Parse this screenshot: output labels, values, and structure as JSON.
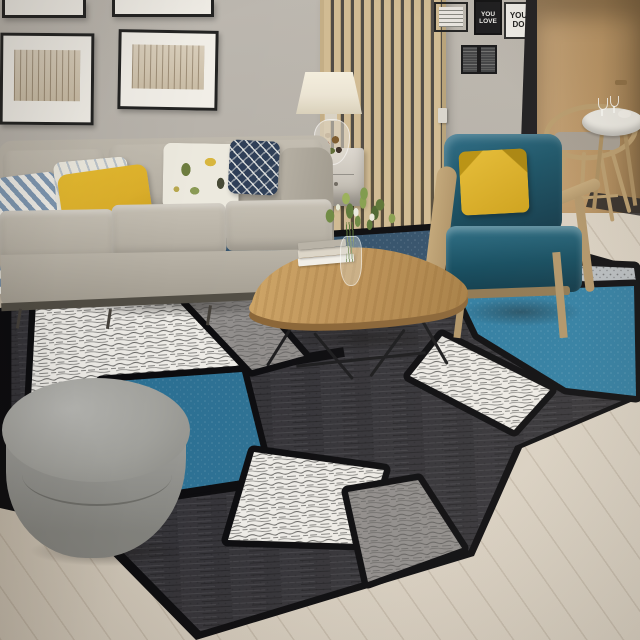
{
  "scene": {
    "type": "living-room-photograph",
    "posters": {
      "black_poster_text": "YOU LOVE",
      "white_poster_text": "YOU DO"
    }
  },
  "palette": {
    "wall": "#b6b1a9",
    "wall_dark": "#a39e96",
    "floor": "#cfc6b7",
    "floor_light": "#ddd5c7",
    "door": "#c2a075",
    "door_dark": "#8f6f45",
    "doorway_shadow": "#1b1a1d",
    "divider_wood": "#d0ba92",
    "sofa": "#b6b0a4",
    "sofa_light": "#c6c0b4",
    "sofa_rail": "#514d44",
    "pillow_yellow": "#ddb02b",
    "pillow_chevron": "#7f98b2",
    "pillow_navy": "#2e3e57",
    "pillow_cream": "#ece9de",
    "armchair_teal": "#175064",
    "armchair_teal_light": "#2b6d85",
    "armchair_wood": "#b09468",
    "rug_black": "#0b0b0e",
    "rug_charcoal": "#343338",
    "rug_white": "#edebe6",
    "rug_grey": "#908d8b",
    "rug_navy": "#33516b",
    "rug_teal": "#2f7da2",
    "rug_teal_deep": "#2c7093",
    "rug_lightband": "#b7bcc0",
    "ottoman": "#a0a09b",
    "ottoman_dark": "#82827d",
    "table_wood": "#bf9459",
    "table_wood_dark": "#8a6537",
    "lamp_shade": "#ebe4d3",
    "dining_wood": "#b89b6c",
    "dining_seat": "#a59d92",
    "table_top": "#eae8e2",
    "poster_black_bg": "#17171a",
    "poster_white_bg": "#f0eee9",
    "frame_black": "#232322",
    "art_sepia": "#d9cebb",
    "plant_green": "#5e7a3a",
    "plant_green_light": "#87a050"
  }
}
